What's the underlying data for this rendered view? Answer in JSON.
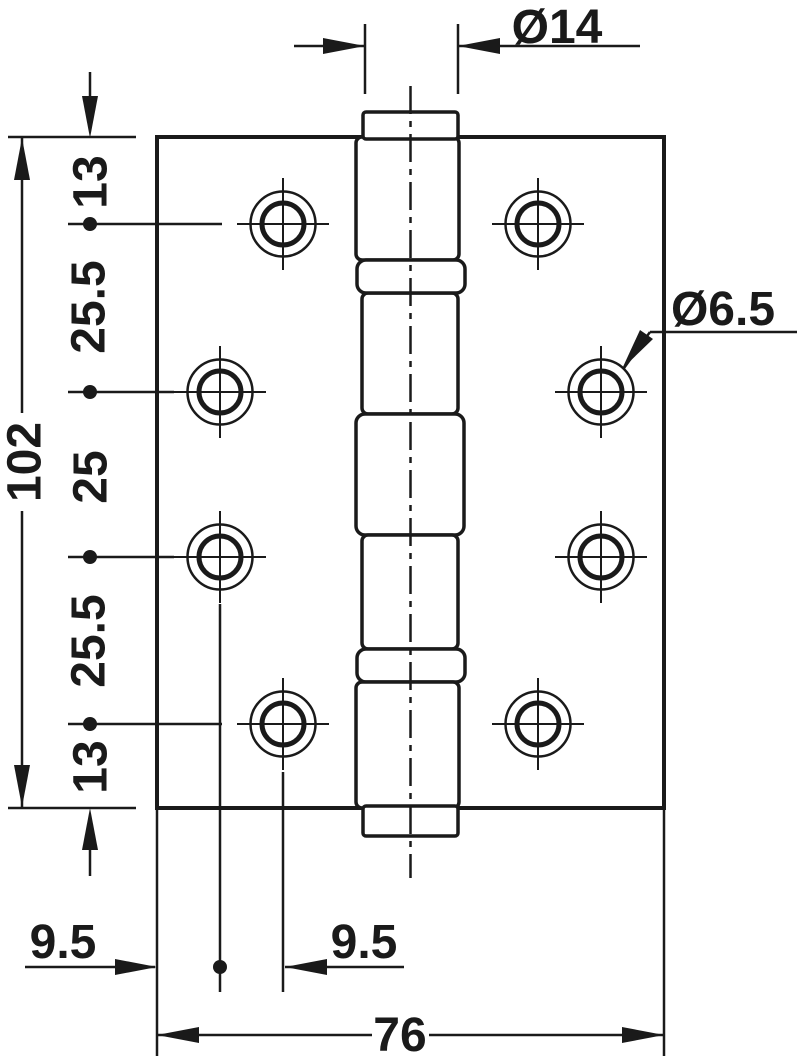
{
  "drawing": {
    "kind": "technical-dimension-drawing",
    "subject": "butt-hinge front view",
    "colors": {
      "line": "#1a1a1a",
      "background": "#ffffff"
    },
    "labels": {
      "pin_diameter": "Ø14",
      "hole_diameter": "Ø6.5",
      "total_height": "102",
      "top_edge_to_hole": "13",
      "hole_spacing_upper": "25.5",
      "hole_spacing_middle": "25",
      "hole_spacing_lower": "25.5",
      "hole_to_bottom_edge": "13",
      "edge_to_first_hole_column": "9.5",
      "first_to_second_hole_column": "9.5",
      "total_width": "76"
    }
  }
}
